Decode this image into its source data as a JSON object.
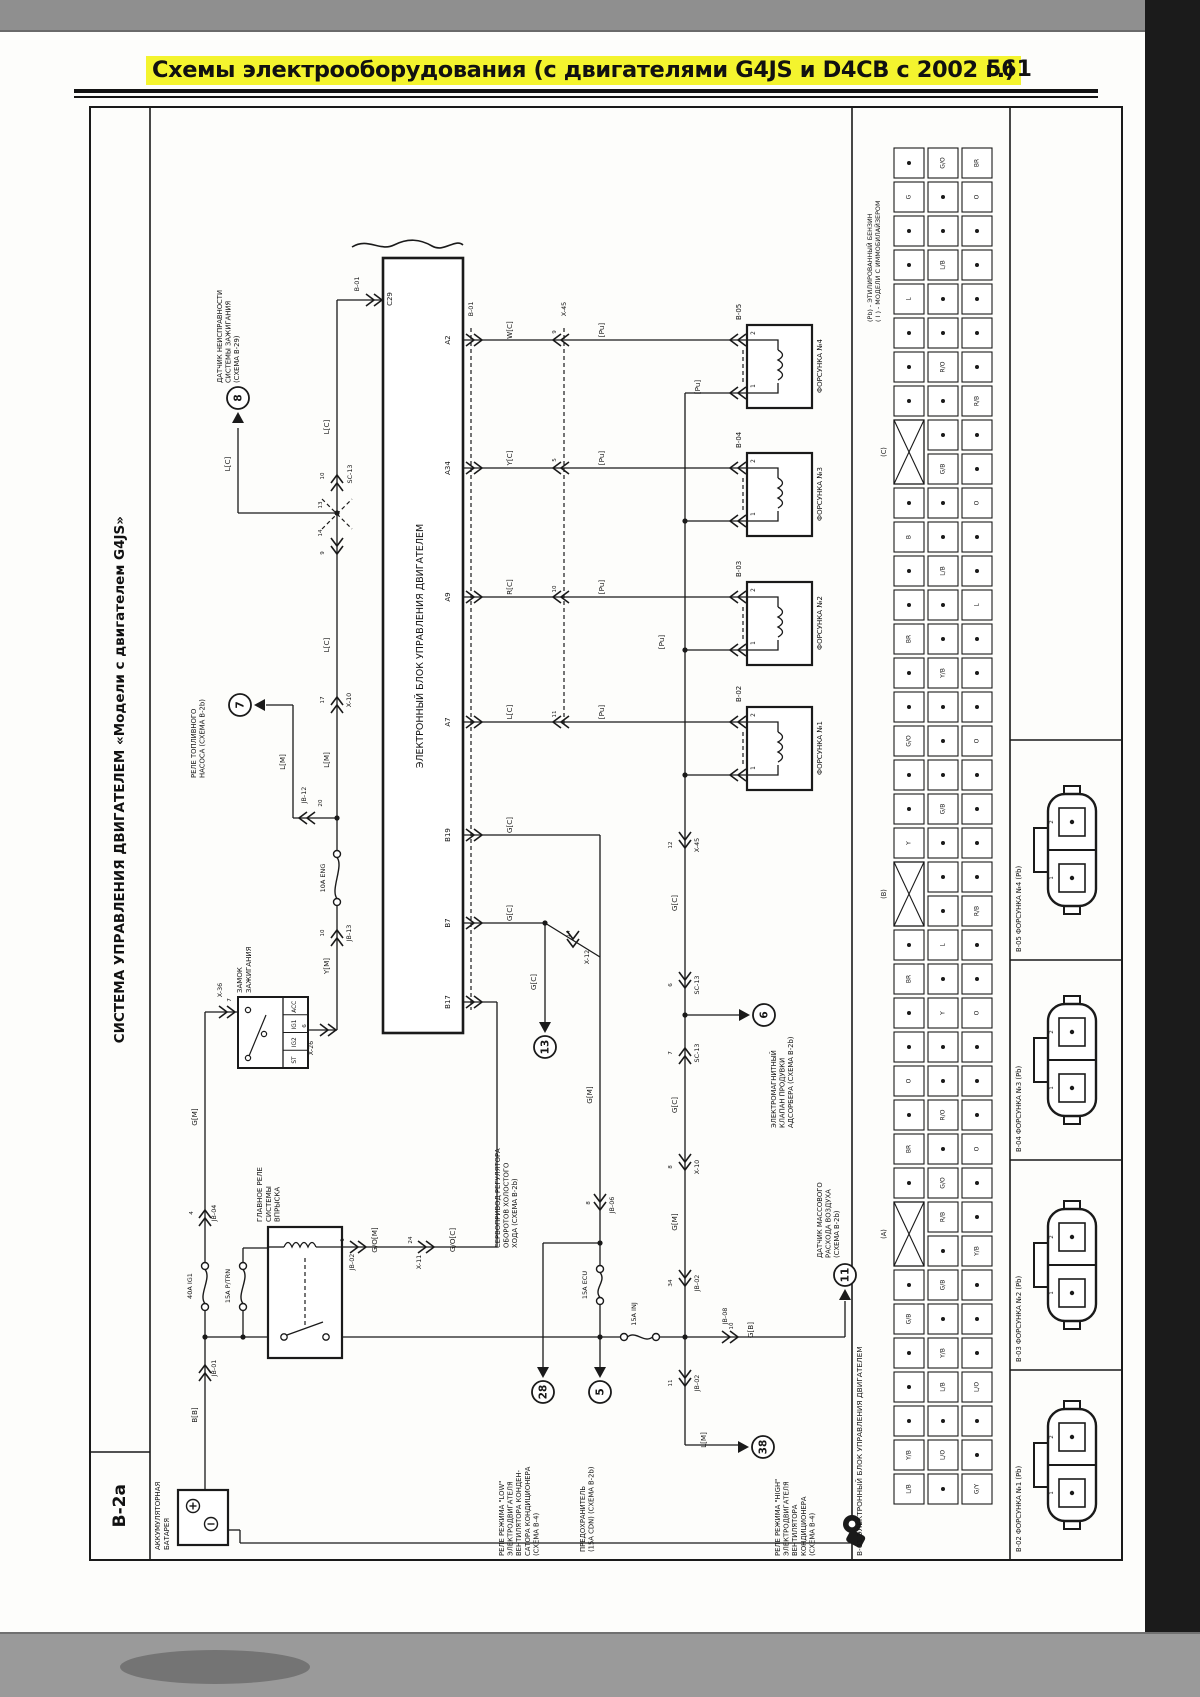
{
  "header": {
    "title": "Схемы электрооборудования (с двигателями G4JS и D4CB с 2002 г.)",
    "page": "561"
  },
  "sidebar": {
    "code": "B-2a",
    "title": "СИСТЕМА УПРАВЛЕНИЯ ДВИГАТЕЛЕМ «Модели с двигателем G4JS»"
  },
  "ecm": {
    "label": "ЭЛЕКТРОННЫЙ БЛОК УПРАВЛЕНИЯ ДВИГАТЕЛЕМ",
    "top_pin": "C29",
    "pins": [
      "A2",
      "A34",
      "A9",
      "A7",
      "B19",
      "B7",
      "B17"
    ]
  },
  "battery": {
    "lines": [
      "АККУМУЛЯТОРНАЯ",
      "БАТАРЕЯ"
    ]
  },
  "ignition": {
    "lines": [
      "ЗАМОК",
      "ЗАЖИГАНИЯ"
    ],
    "contacts": [
      "ACC",
      "IG1",
      "IG2",
      "ST"
    ]
  },
  "relay": {
    "lines": [
      "ГЛАВНОЕ РЕЛЕ",
      "СИСТЕМЫ",
      "ВПРЫСКА"
    ]
  },
  "injectors": [
    {
      "id": "B-05",
      "name": "ФОРСУНКА №4",
      "pins": [
        "2",
        "1"
      ]
    },
    {
      "id": "B-04",
      "name": "ФОРСУНКА №3",
      "pins": [
        "2",
        "1"
      ]
    },
    {
      "id": "B-03",
      "name": "ФОРСУНКА №2",
      "pins": [
        "2",
        "1"
      ]
    },
    {
      "id": "B-02",
      "name": "ФОРСУНКА №1",
      "pins": [
        "2",
        "1"
      ]
    }
  ],
  "fuse_labels": [
    "40A IG1",
    "15A P/TRN",
    "10A ENG",
    "15A ECU",
    "15A INJ"
  ],
  "callouts": [
    {
      "num": "8",
      "lines": [
        "ДАТЧИК НЕИСПРАВНОСТИ",
        "СИСТЕМЫ ЗАЖИГАНИЯ",
        "(СХЕМА B-29)"
      ]
    },
    {
      "num": "7",
      "lines": [
        "РЕЛЕ ТОПЛИВНОГО",
        "НАСОСА (СХЕМА B-2b)"
      ]
    },
    {
      "num": "13",
      "lines": [
        "СЕРВОПРИВОД РЕГУЛЯТОРА",
        "ОБОРОТОВ ХОЛОСТОГО",
        "ХОДА (СХЕМА B-2b)"
      ]
    },
    {
      "num": "6",
      "lines": [
        "ЭЛЕКТРОМАГНИТНЫЙ",
        "КЛАПАН ПРОДУВКИ",
        "АДСОРБЕРА (СХЕМА B-2b)"
      ]
    },
    {
      "num": "11",
      "lines": [
        "ДАТЧИК МАССОВОГО",
        "РАСХОДА ВОЗДУХА",
        "(СХЕМА B-2b)"
      ]
    },
    {
      "num": "28",
      "lines": [
        "РЕЛЕ РЕЖИМА \"LOW\"",
        "ЭЛЕКТРОДВИГАТЕЛЯ",
        "ВЕНТИЛЯТОРА КОНДЕН-",
        "САТОРА КОНДИЦИОНЕРА",
        "(СХЕМА B-4)"
      ]
    },
    {
      "num": "5",
      "lines": [
        "ПРЕДОХРАНИТЕЛЬ",
        "(15A CDN) (СХЕМА B-2b)"
      ]
    },
    {
      "num": "38",
      "lines": [
        "РЕЛЕ РЕЖИМА \"HIGH\"",
        "ЭЛЕКТРОДВИГАТЕЛЯ",
        "ВЕНТИЛЯТОРА",
        "КОНДИЦИОНЕРА",
        "(СХЕМА B-4)"
      ]
    }
  ],
  "wires": [
    "B[B]",
    "G[M]",
    "Y[M]",
    "L[M]",
    "L[C]",
    "L[C]",
    "L[C]",
    "L[M]",
    "W[C]",
    "Y[C]",
    "R[C]",
    "L[C]",
    "[Pu]",
    "[Pu]",
    "[Pu]",
    "[Pu]",
    "[Pu]",
    "[Pu]",
    "G[C]",
    "G[C]",
    "G[C]",
    "G[M]",
    "G/O[M]",
    "G/O[C]",
    "G[C]",
    "G[C]",
    "G[M]",
    "G[B]",
    "L[M]"
  ],
  "conns": [
    "JB-01",
    "JB-04",
    "X-36",
    "X-26",
    "JB-13",
    "JB-12",
    "X-10",
    "SC-13",
    "B-01",
    "B-01",
    "X-45",
    "JB-02",
    "X-11",
    "X-12",
    "JB-06",
    "X-45",
    "SC-13",
    "SC-13",
    "X-10",
    "JB-02",
    "JB-02",
    "JB-08"
  ],
  "pin_nums": [
    "9",
    "5",
    "10",
    "11",
    "12",
    "6",
    "7",
    "8",
    "34",
    "11",
    "10",
    "20",
    "10",
    "17",
    "10",
    "9",
    "13",
    "14",
    "4",
    "6",
    "7",
    "24",
    "1",
    "8",
    "14"
  ],
  "right_panel": {
    "caption": "B-01  ЭЛЕКТРОННЫЙ БЛОК УПРАВЛЕНИЯ ДВИГАТЕЛЕМ",
    "notes": [
      "(Pb) - ЭТИЛИРОВАННЫЙ БЕНЗИН",
      "( I ) - МОДЕЛИ С ИММОБИЛАЙЗЕРОМ"
    ],
    "groups": [
      "(C)",
      "(B)",
      "(A)"
    ],
    "grid_rows": [
      ".|G/O|BR",
      "G|.|O",
      ".|.|.",
      ".|L/B|.",
      "L|.|.",
      ".|.|.",
      ".|R/O|.",
      ".|.|R/B",
      "X|.|.",
      "X|G/B|.",
      ".|.|O",
      "B|.|.",
      ".|L/B|.",
      ".|.|L",
      "BR|.|.",
      ".|Y/B|.",
      ".|.|.",
      "G/O|.|O",
      ".|.|.",
      ".|G/B|.",
      "Y|.|.",
      "X|.|.",
      "X|.|R/B",
      ".|L|.",
      "BR|.|.",
      ".|Y|O",
      ".|.|.",
      "O|.|.",
      ".|R/O|.",
      "BR|.|O",
      ".|G/O|.",
      "X|R/B|.",
      "X|.|Y/B",
      ".|G/B|.",
      "G/B|.|.",
      ".|Y/B|.",
      ".|L/B|L/O",
      ".|.|.",
      "Y/B|L/O|.",
      "L/B|.|G/Y"
    ],
    "cards": [
      {
        "id": "B-05",
        "name": "B-05 ФОРСУНКА №4 (Pb)",
        "pins": [
          "2",
          "1"
        ]
      },
      {
        "id": "B-04",
        "name": "B-04 ФОРСУНКА №3 (Pb)",
        "pins": [
          "2",
          "1"
        ]
      },
      {
        "id": "B-03",
        "name": "B-03 ФОРСУНКА №2 (Pb)",
        "pins": [
          "2",
          "1"
        ]
      },
      {
        "id": "B-02",
        "name": "B-02 ФОРСУНКА №1 (Pb)",
        "pins": [
          "2",
          "1"
        ]
      }
    ]
  }
}
